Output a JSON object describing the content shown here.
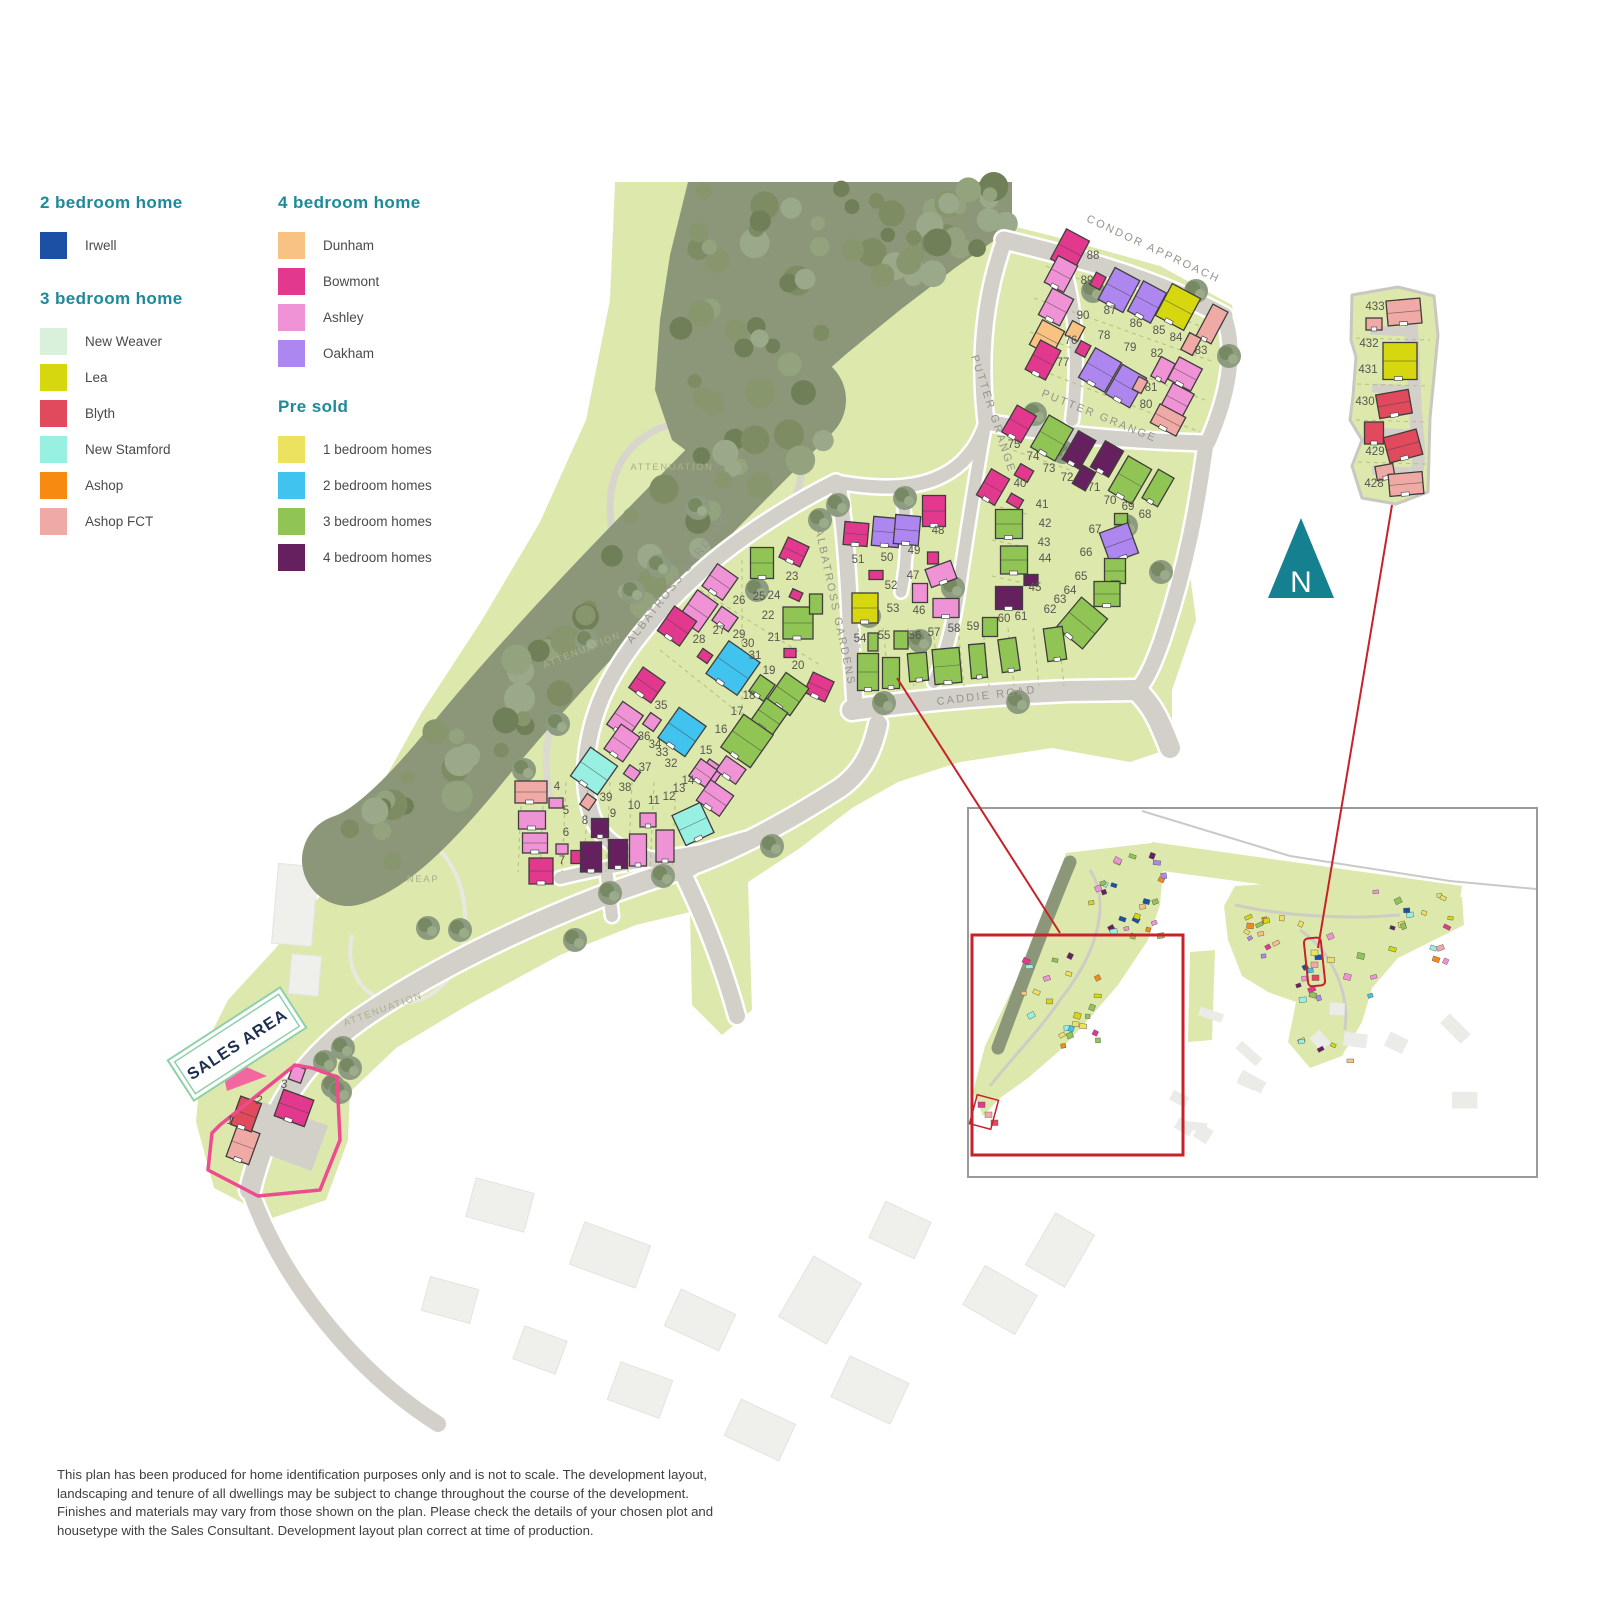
{
  "legend": {
    "sections": [
      {
        "title": "2 bedroom home",
        "items": [
          {
            "label": "Irwell",
            "color": "#1b50a4"
          }
        ]
      },
      {
        "title": "3 bedroom home",
        "items": [
          {
            "label": "New Weaver",
            "color": "#d9f0da"
          },
          {
            "label": "Lea",
            "color": "#d6d70e"
          },
          {
            "label": "Blyth",
            "color": "#e1495c"
          },
          {
            "label": "New Stamford",
            "color": "#98f0e3"
          },
          {
            "label": "Ashop",
            "color": "#f78a10"
          },
          {
            "label": "Ashop FCT",
            "color": "#f0aaa6"
          }
        ]
      },
      {
        "title": "4 bedroom home",
        "items": [
          {
            "label": "Dunham",
            "color": "#f7c282"
          },
          {
            "label": "Bowmont",
            "color": "#e2398e"
          },
          {
            "label": "Ashley",
            "color": "#f093d6"
          },
          {
            "label": "Oakham",
            "color": "#ad87ef"
          }
        ]
      },
      {
        "title": "Pre sold",
        "items": [
          {
            "label": "1 bedroom homes",
            "color": "#ece25d"
          },
          {
            "label": "2 bedroom homes",
            "color": "#41c3ef"
          },
          {
            "label": "3 bedroom homes",
            "color": "#90c455"
          },
          {
            "label": "4 bedroom homes",
            "color": "#662060"
          }
        ]
      }
    ]
  },
  "colors": {
    "terrain": "#dde8ad",
    "road": "#d3d0c9",
    "road_edge": "#ffffff",
    "woodland": "#8b9778",
    "red": "#c7222a",
    "sales_pink": "#ef4b8f",
    "arrow_pink": "#f2679f",
    "sign_green": "#8fd0a9",
    "north_teal": "#15808f",
    "house_stroke": "#3f3e3c",
    "palette": {
      "irw": "#1b50a4",
      "nw": "#d9f0da",
      "lea": "#d6d70e",
      "bly": "#e1495c",
      "stam": "#98f0e3",
      "ashop": "#f78a10",
      "fct": "#f0aaa6",
      "dun": "#f7c282",
      "bow": "#e2398e",
      "ash": "#f093d6",
      "oak": "#ad87ef",
      "y1": "#ece25d",
      "b2": "#41c3ef",
      "g3": "#90c455",
      "p4": "#662060"
    }
  },
  "map": {
    "north_label": "N",
    "sales_area_label": "SALES AREA",
    "road_labels": [
      {
        "text": "CONDOR APPROACH",
        "x": 1152,
        "y": 252,
        "r": 25
      },
      {
        "text": "PUTTER GRANGE",
        "x": 990,
        "y": 415,
        "r": 72
      },
      {
        "text": "PUTTER GRANGE",
        "x": 1098,
        "y": 419,
        "r": 22
      },
      {
        "text": "ALBATROSS GARDENS",
        "x": 681,
        "y": 581,
        "r": -52
      },
      {
        "text": "ALBATROSS GARDENS",
        "x": 832,
        "y": 608,
        "r": 78
      },
      {
        "text": "CADDIE ROAD",
        "x": 987,
        "y": 699,
        "r": -7
      }
    ],
    "area_labels": [
      {
        "text": "ATTENUATION",
        "x": 672,
        "y": 470,
        "r": 0
      },
      {
        "text": "ATTENUATION",
        "x": 583,
        "y": 653,
        "r": -22
      },
      {
        "text": "ATTENUATION",
        "x": 384,
        "y": 1012,
        "r": -20
      },
      {
        "text": "NEAP",
        "x": 423,
        "y": 882,
        "r": 0
      }
    ],
    "houses": [
      [
        1070,
        250,
        26,
        34,
        28,
        "bow"
      ],
      [
        1061,
        274,
        22,
        30,
        28,
        "ash"
      ],
      [
        1098,
        281,
        11,
        14,
        28,
        "bow"
      ],
      [
        1119,
        290,
        28,
        36,
        28,
        "oak"
      ],
      [
        1147,
        302,
        26,
        34,
        28,
        "oak"
      ],
      [
        1178,
        307,
        32,
        36,
        28,
        "lea"
      ],
      [
        1212,
        324,
        17,
        36,
        28,
        "fct"
      ],
      [
        1191,
        344,
        13,
        19,
        28,
        "fct"
      ],
      [
        1056,
        307,
        24,
        30,
        28,
        "ash"
      ],
      [
        1047,
        338,
        25,
        28,
        28,
        "dun"
      ],
      [
        1075,
        331,
        14,
        16,
        28,
        "dun"
      ],
      [
        1043,
        360,
        23,
        33,
        28,
        "bow"
      ],
      [
        1083,
        349,
        11,
        13,
        28,
        "bow"
      ],
      [
        1100,
        370,
        30,
        34,
        30,
        "oak"
      ],
      [
        1126,
        386,
        28,
        34,
        30,
        "oak"
      ],
      [
        1163,
        370,
        16,
        22,
        28,
        "ash"
      ],
      [
        1185,
        374,
        26,
        25,
        28,
        "ash"
      ],
      [
        1140,
        385,
        10,
        14,
        28,
        "fct"
      ],
      [
        1177,
        401,
        24,
        28,
        28,
        "ash"
      ],
      [
        1168,
        420,
        29,
        21,
        28,
        "fct"
      ],
      [
        1019,
        424,
        22,
        31,
        30,
        "bow"
      ],
      [
        1052,
        438,
        28,
        37,
        30,
        "g3"
      ],
      [
        1079,
        450,
        20,
        33,
        30,
        "p4"
      ],
      [
        1107,
        459,
        21,
        30,
        30,
        "p4"
      ],
      [
        1084,
        478,
        15,
        21,
        30,
        "p4"
      ],
      [
        1130,
        480,
        27,
        40,
        30,
        "g3"
      ],
      [
        1158,
        488,
        18,
        33,
        30,
        "g3"
      ],
      [
        1121,
        519,
        13,
        11,
        0,
        "g3"
      ],
      [
        1119,
        543,
        30,
        32,
        -20,
        "oak"
      ],
      [
        1115,
        571,
        21,
        25,
        0,
        "g3"
      ],
      [
        1107,
        594,
        26,
        25,
        0,
        "g3"
      ],
      [
        1082,
        623,
        34,
        39,
        40,
        "g3"
      ],
      [
        993,
        487,
        21,
        30,
        30,
        "bow"
      ],
      [
        1024,
        473,
        15,
        13,
        30,
        "bow"
      ],
      [
        1015,
        501,
        14,
        10,
        30,
        "bow"
      ],
      [
        1009,
        524,
        27,
        29,
        0,
        "g3"
      ],
      [
        1014,
        560,
        27,
        28,
        0,
        "g3"
      ],
      [
        1031,
        580,
        14,
        11,
        0,
        "p4"
      ],
      [
        1009,
        598,
        27,
        23,
        0,
        "p4"
      ],
      [
        865,
        608,
        26,
        30,
        0,
        "lea"
      ],
      [
        876,
        575,
        14,
        9,
        0,
        "bow"
      ],
      [
        856,
        534,
        24,
        23,
        5,
        "bow"
      ],
      [
        886,
        532,
        27,
        29,
        5,
        "oak"
      ],
      [
        907,
        530,
        25,
        29,
        5,
        "oak"
      ],
      [
        934,
        511,
        23,
        31,
        0,
        "bow"
      ],
      [
        933,
        558,
        11,
        12,
        0,
        "bow"
      ],
      [
        941,
        574,
        27,
        19,
        -20,
        "ash"
      ],
      [
        920,
        593,
        15,
        19,
        0,
        "ash"
      ],
      [
        946,
        608,
        26,
        19,
        0,
        "ash"
      ],
      [
        868,
        672,
        21,
        37,
        0,
        "g3"
      ],
      [
        891,
        673,
        17,
        31,
        0,
        "g3"
      ],
      [
        918,
        667,
        19,
        28,
        -5,
        "g3"
      ],
      [
        947,
        666,
        27,
        35,
        -5,
        "g3"
      ],
      [
        978,
        661,
        16,
        34,
        -5,
        "g3"
      ],
      [
        1009,
        655,
        18,
        33,
        -8,
        "g3"
      ],
      [
        1055,
        644,
        19,
        33,
        -8,
        "g3"
      ],
      [
        873,
        642,
        10,
        18,
        0,
        "g3"
      ],
      [
        901,
        640,
        14,
        18,
        0,
        "g3"
      ],
      [
        990,
        627,
        15,
        19,
        0,
        "g3"
      ],
      [
        762,
        563,
        23,
        31,
        0,
        "g3"
      ],
      [
        794,
        552,
        23,
        22,
        25,
        "bow"
      ],
      [
        796,
        595,
        11,
        9,
        25,
        "bow"
      ],
      [
        798,
        623,
        30,
        32,
        0,
        "g3"
      ],
      [
        790,
        653,
        12,
        9,
        0,
        "bow"
      ],
      [
        819,
        687,
        23,
        22,
        25,
        "bow"
      ],
      [
        720,
        582,
        25,
        27,
        35,
        "ash"
      ],
      [
        698,
        611,
        25,
        34,
        35,
        "ash"
      ],
      [
        677,
        626,
        27,
        30,
        35,
        "bow"
      ],
      [
        725,
        619,
        20,
        17,
        35,
        "ash"
      ],
      [
        705,
        656,
        12,
        10,
        35,
        "bow"
      ],
      [
        733,
        668,
        38,
        40,
        35,
        "b2"
      ],
      [
        762,
        688,
        18,
        20,
        35,
        "g3"
      ],
      [
        788,
        694,
        28,
        33,
        35,
        "g3"
      ],
      [
        769,
        717,
        26,
        28,
        35,
        "g3"
      ],
      [
        747,
        741,
        36,
        40,
        35,
        "g3"
      ],
      [
        647,
        685,
        27,
        25,
        35,
        "bow"
      ],
      [
        625,
        720,
        25,
        28,
        35,
        "ash"
      ],
      [
        652,
        722,
        13,
        14,
        35,
        "ash"
      ],
      [
        682,
        732,
        33,
        37,
        35,
        "b2"
      ],
      [
        622,
        743,
        23,
        30,
        35,
        "ash"
      ],
      [
        632,
        773,
        13,
        11,
        35,
        "ash"
      ],
      [
        712,
        771,
        18,
        17,
        35,
        "ash"
      ],
      [
        731,
        770,
        24,
        18,
        35,
        "ash"
      ],
      [
        594,
        771,
        33,
        35,
        35,
        "stam"
      ],
      [
        588,
        802,
        11,
        13,
        35,
        "fct"
      ],
      [
        816,
        604,
        13,
        20,
        0,
        "g3"
      ],
      [
        531,
        792,
        32,
        22,
        0,
        "fct"
      ],
      [
        556,
        803,
        14,
        10,
        0,
        "ash"
      ],
      [
        532,
        820,
        27,
        18,
        0,
        "ash"
      ],
      [
        535,
        843,
        25,
        20,
        0,
        "ash"
      ],
      [
        562,
        849,
        12,
        10,
        0,
        "ash"
      ],
      [
        576,
        857,
        10,
        13,
        0,
        "bow"
      ],
      [
        541,
        871,
        24,
        26,
        0,
        "bow"
      ],
      [
        600,
        828,
        17,
        19,
        0,
        "p4"
      ],
      [
        591,
        857,
        21,
        30,
        0,
        "p4"
      ],
      [
        618,
        854,
        19,
        29,
        0,
        "p4"
      ],
      [
        638,
        850,
        17,
        32,
        0,
        "ash"
      ],
      [
        665,
        846,
        18,
        32,
        0,
        "ash"
      ],
      [
        648,
        820,
        16,
        14,
        0,
        "ash"
      ],
      [
        693,
        824,
        31,
        33,
        -25,
        "stam"
      ],
      [
        703,
        773,
        20,
        21,
        35,
        "ash"
      ],
      [
        715,
        798,
        28,
        25,
        35,
        "ash"
      ],
      [
        243,
        1145,
        24,
        33,
        20,
        "fct"
      ],
      [
        246,
        1114,
        22,
        30,
        20,
        "bly"
      ],
      [
        294,
        1108,
        32,
        28,
        20,
        "bow"
      ],
      [
        297,
        1074,
        13,
        15,
        20,
        "ash"
      ],
      [
        1404,
        312,
        34,
        25,
        -5,
        "fct"
      ],
      [
        1374,
        324,
        16,
        12,
        0,
        "fct"
      ],
      [
        1400,
        361,
        34,
        37,
        0,
        "lea"
      ],
      [
        1394,
        404,
        33,
        24,
        -10,
        "bly"
      ],
      [
        1374,
        433,
        19,
        22,
        0,
        "bly"
      ],
      [
        1403,
        446,
        34,
        26,
        -15,
        "bly"
      ],
      [
        1385,
        472,
        18,
        14,
        -10,
        "fct"
      ],
      [
        1406,
        484,
        34,
        22,
        -5,
        "fct"
      ]
    ],
    "plot_labels": [
      [
        1,
        230,
        1124,
        1
      ],
      [
        2,
        259,
        1104,
        1
      ],
      [
        3,
        284,
        1088,
        1
      ],
      [
        4,
        557,
        790
      ],
      [
        5,
        566,
        814
      ],
      [
        6,
        566,
        836
      ],
      [
        7,
        562,
        864
      ],
      [
        8,
        585,
        824
      ],
      [
        9,
        613,
        817
      ],
      [
        10,
        634,
        809
      ],
      [
        11,
        654,
        804
      ],
      [
        12,
        669,
        800
      ],
      [
        13,
        679,
        792
      ],
      [
        14,
        688,
        784
      ],
      [
        15,
        706,
        754
      ],
      [
        16,
        721,
        733
      ],
      [
        17,
        737,
        715
      ],
      [
        18,
        749,
        699
      ],
      [
        19,
        769,
        674
      ],
      [
        20,
        798,
        669
      ],
      [
        21,
        774,
        641
      ],
      [
        22,
        768,
        619
      ],
      [
        23,
        792,
        580
      ],
      [
        24,
        774,
        599
      ],
      [
        25,
        759,
        600
      ],
      [
        26,
        739,
        604
      ],
      [
        27,
        719,
        634
      ],
      [
        28,
        699,
        643
      ],
      [
        29,
        739,
        638
      ],
      [
        30,
        748,
        647
      ],
      [
        31,
        755,
        659
      ],
      [
        32,
        671,
        767
      ],
      [
        33,
        662,
        756
      ],
      [
        34,
        655,
        748
      ],
      [
        35,
        661,
        709
      ],
      [
        36,
        644,
        740
      ],
      [
        37,
        645,
        771
      ],
      [
        38,
        625,
        791
      ],
      [
        39,
        606,
        801
      ],
      [
        40,
        1020,
        487
      ],
      [
        41,
        1042,
        508
      ],
      [
        42,
        1045,
        527
      ],
      [
        43,
        1044,
        546
      ],
      [
        44,
        1045,
        562
      ],
      [
        45,
        1035,
        591
      ],
      [
        46,
        919,
        614
      ],
      [
        47,
        913,
        579
      ],
      [
        48,
        938,
        534
      ],
      [
        49,
        914,
        554
      ],
      [
        50,
        887,
        561
      ],
      [
        51,
        858,
        563
      ],
      [
        52,
        891,
        589
      ],
      [
        53,
        893,
        612
      ],
      [
        54,
        860,
        642
      ],
      [
        55,
        884,
        639
      ],
      [
        56,
        915,
        639
      ],
      [
        57,
        934,
        636
      ],
      [
        58,
        954,
        632
      ],
      [
        59,
        973,
        630
      ],
      [
        60,
        1004,
        622
      ],
      [
        61,
        1021,
        620
      ],
      [
        62,
        1050,
        613
      ],
      [
        63,
        1060,
        603
      ],
      [
        64,
        1070,
        594
      ],
      [
        65,
        1081,
        580
      ],
      [
        66,
        1086,
        556
      ],
      [
        67,
        1095,
        533
      ],
      [
        68,
        1145,
        518
      ],
      [
        69,
        1128,
        510
      ],
      [
        70,
        1110,
        504
      ],
      [
        71,
        1094,
        491
      ],
      [
        72,
        1067,
        481
      ],
      [
        73,
        1049,
        472
      ],
      [
        74,
        1033,
        460
      ],
      [
        75,
        1014,
        448
      ],
      [
        76,
        1071,
        344
      ],
      [
        77,
        1063,
        366
      ],
      [
        78,
        1104,
        339
      ],
      [
        79,
        1130,
        351
      ],
      [
        80,
        1146,
        408
      ],
      [
        81,
        1151,
        391
      ],
      [
        82,
        1157,
        357
      ],
      [
        83,
        1201,
        354
      ],
      [
        84,
        1176,
        341
      ],
      [
        85,
        1159,
        334
      ],
      [
        86,
        1136,
        327
      ],
      [
        87,
        1110,
        314
      ],
      [
        88,
        1093,
        259
      ],
      [
        89,
        1087,
        284
      ],
      [
        90,
        1083,
        319
      ],
      [
        428,
        1374,
        487
      ],
      [
        429,
        1375,
        455
      ],
      [
        430,
        1365,
        405
      ],
      [
        431,
        1368,
        373
      ],
      [
        432,
        1369,
        347
      ],
      [
        433,
        1375,
        310
      ]
    ]
  },
  "disclaimer": "This plan has been produced for home identification purposes only and is not to scale. The development layout, landscaping and tenure of all dwellings may be subject to change throughout the course of the development. Finishes and materials may vary from those shown on the plan. Please check the details of your chosen plot and housetype with the Sales Consultant. Development layout plan correct at time of production."
}
